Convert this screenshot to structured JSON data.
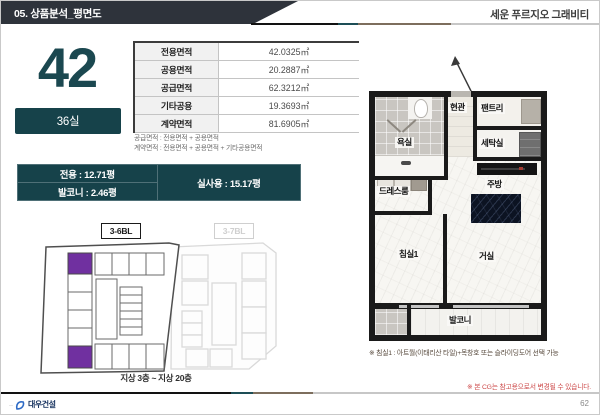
{
  "header": {
    "section_title": "05. 상품분석_평면도",
    "project_title": "세운 푸르지오 그래비티"
  },
  "unit_summary": {
    "type_number": "42",
    "room_count": "36실"
  },
  "area_table": {
    "rows": [
      {
        "label": "전용면적",
        "value": "42.0325㎡"
      },
      {
        "label": "공용면적",
        "value": "20.2887㎡"
      },
      {
        "label": "공급면적",
        "value": "62.3212㎡"
      },
      {
        "label": "기타공용",
        "value": "19.3693㎡"
      },
      {
        "label": "계약면적",
        "value": "81.6905㎡"
      }
    ],
    "formula_lines": [
      "공급면적 : 전용면적 + 공용면적",
      "계약면적 : 전용면적 + 공용면적 + 기타공용면적"
    ]
  },
  "pyeong_table": {
    "exclusive": "전용 : 12.71평",
    "balcony": "발코니 : 2.46평",
    "actual_use": "실사용 : 15.17평"
  },
  "site_plan": {
    "active_block": "3-6BL",
    "inactive_block": "3-7BL",
    "floor_range": "지상 3층 ~ 지상 20층"
  },
  "floor_plan": {
    "rooms": {
      "entrance": "현관",
      "pantry": "팬트리",
      "bathroom": "욕실",
      "laundry": "세탁실",
      "dressroom": "드레스룸",
      "kitchen": "주방",
      "bedroom1": "침실1",
      "living_room": "거실",
      "balcony": "발코니"
    }
  },
  "footnotes": {
    "bedroom_option": "※ 침실1 : 아트월(이태리산 타일)+목창호 또는 슬라이딩도어 선택 가능",
    "cg_disclaimer": "※ 본 CG는 참고용으로서 변경될 수 있습니다."
  },
  "footer": {
    "company": "대우건설",
    "page_number": "62"
  },
  "colors": {
    "accent_teal": "#16424a",
    "header_bar": "#2e333b",
    "highlight_purple": "#7030a0",
    "disclaimer_red": "#cd4b4b"
  }
}
